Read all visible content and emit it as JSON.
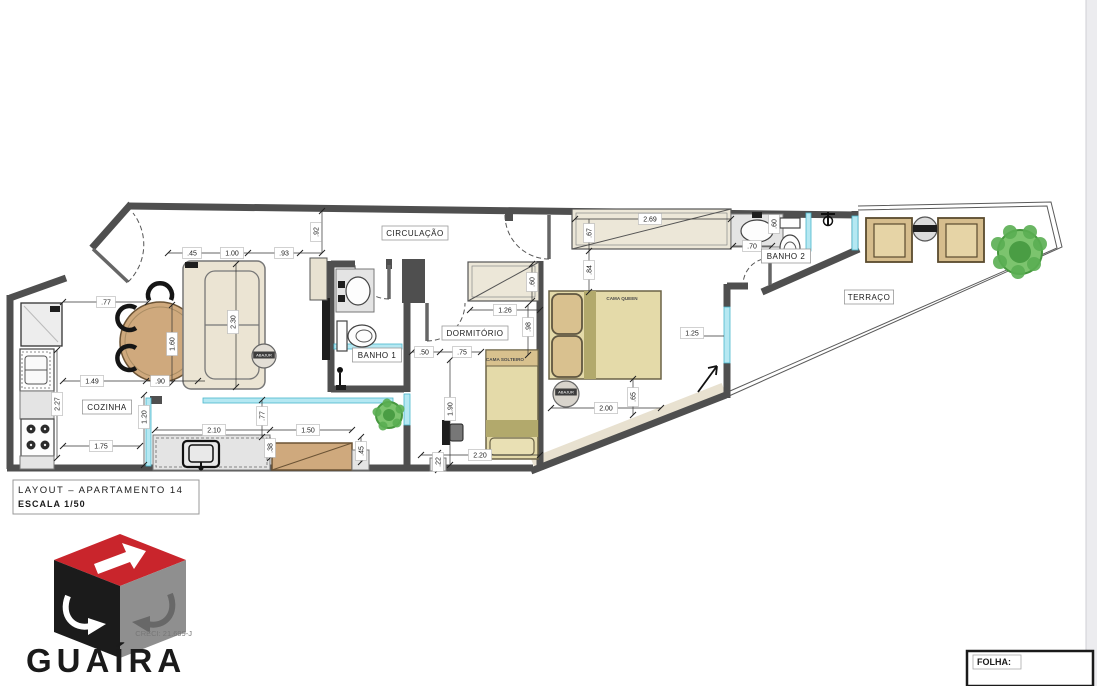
{
  "document": {
    "title_block": {
      "line1": "LAYOUT – APARTAMENTO 14",
      "line2": "ESCALA 1/50"
    },
    "folha_label": "FOLHA:",
    "logo": {
      "brand": "GUAÍRA",
      "creci": "CRECI: 21.699-J",
      "colors": {
        "red": "#c9252c",
        "black": "#1b1b1b",
        "gray": "#8f8f8f"
      }
    }
  },
  "plan": {
    "colors": {
      "wall": "#4f4f4f",
      "glass": "#b5e8f2",
      "wood": "#cfa97d",
      "bed": "#e4daa9",
      "plant": "#7cc46e",
      "stone": "#e4e4e4"
    },
    "rooms": [
      {
        "t": "CIRCULAÇÃO",
        "x": 415,
        "y": 233
      },
      {
        "t": "COZINHA",
        "x": 107,
        "y": 407
      },
      {
        "t": "BANHO 1",
        "x": 377,
        "y": 355
      },
      {
        "t": "DORMITÓRIO",
        "x": 475,
        "y": 333
      },
      {
        "t": "BANHO 2",
        "x": 786,
        "y": 256
      },
      {
        "t": "TERRAÇO",
        "x": 869,
        "y": 297
      }
    ],
    "furniture_labels": [
      {
        "t": "CAMA QUEEN",
        "x": 622,
        "y": 300
      },
      {
        "t": "CAMA SOLTEIRO",
        "x": 505,
        "y": 361
      }
    ],
    "tags": [
      {
        "t": "ABAJUR",
        "x": 566,
        "y": 392
      },
      {
        "t": "ABAJUR",
        "x": 264,
        "y": 355
      }
    ],
    "dimensions": [
      {
        "t": ".77",
        "x": 106,
        "y": 302,
        "r": 0
      },
      {
        "t": "1.49",
        "x": 92,
        "y": 381,
        "r": 0
      },
      {
        "t": ".90",
        "x": 160,
        "y": 381,
        "r": 0
      },
      {
        "t": "2.27",
        "x": 57,
        "y": 404,
        "r": 1
      },
      {
        "t": "1.20",
        "x": 144,
        "y": 417,
        "r": 1
      },
      {
        "t": "1.75",
        "x": 101,
        "y": 446,
        "r": 0
      },
      {
        "t": "1.60",
        "x": 172,
        "y": 344,
        "r": 1
      },
      {
        "t": ".45",
        "x": 192,
        "y": 253,
        "r": 0
      },
      {
        "t": "1.00",
        "x": 232,
        "y": 253,
        "r": 0
      },
      {
        "t": ".93",
        "x": 284,
        "y": 253,
        "r": 0
      },
      {
        "t": ".92",
        "x": 316,
        "y": 232,
        "r": 1
      },
      {
        "t": "2.30",
        "x": 233,
        "y": 322,
        "r": 1
      },
      {
        "t": ".50",
        "x": 424,
        "y": 352,
        "r": 0
      },
      {
        "t": ".75",
        "x": 462,
        "y": 352,
        "r": 0
      },
      {
        "t": "1.26",
        "x": 505,
        "y": 310,
        "r": 0
      },
      {
        "t": ".60",
        "x": 532,
        "y": 282,
        "r": 1
      },
      {
        "t": ".98",
        "x": 528,
        "y": 327,
        "r": 1
      },
      {
        "t": "2.69",
        "x": 650,
        "y": 219,
        "r": 0
      },
      {
        "t": ".67",
        "x": 589,
        "y": 233,
        "r": 1
      },
      {
        "t": ".84",
        "x": 589,
        "y": 270,
        "r": 1
      },
      {
        "t": "2.00",
        "x": 606,
        "y": 408,
        "r": 0
      },
      {
        "t": ".65",
        "x": 633,
        "y": 397,
        "r": 1
      },
      {
        "t": "1.25",
        "x": 692,
        "y": 333,
        "r": 0
      },
      {
        "t": ".70",
        "x": 752,
        "y": 246,
        "r": 0
      },
      {
        "t": ".60",
        "x": 774,
        "y": 224,
        "r": 1
      },
      {
        "t": "2.10",
        "x": 214,
        "y": 430,
        "r": 0
      },
      {
        "t": "1.50",
        "x": 308,
        "y": 430,
        "r": 0
      },
      {
        "t": ".77",
        "x": 262,
        "y": 416,
        "r": 1
      },
      {
        "t": ".38",
        "x": 270,
        "y": 448,
        "r": 1
      },
      {
        "t": ".45",
        "x": 361,
        "y": 451,
        "r": 1
      },
      {
        "t": "1.90",
        "x": 450,
        "y": 409,
        "r": 1
      },
      {
        "t": "2.20",
        "x": 480,
        "y": 455,
        "r": 0
      },
      {
        "t": ".22",
        "x": 438,
        "y": 462,
        "r": 1
      }
    ]
  }
}
